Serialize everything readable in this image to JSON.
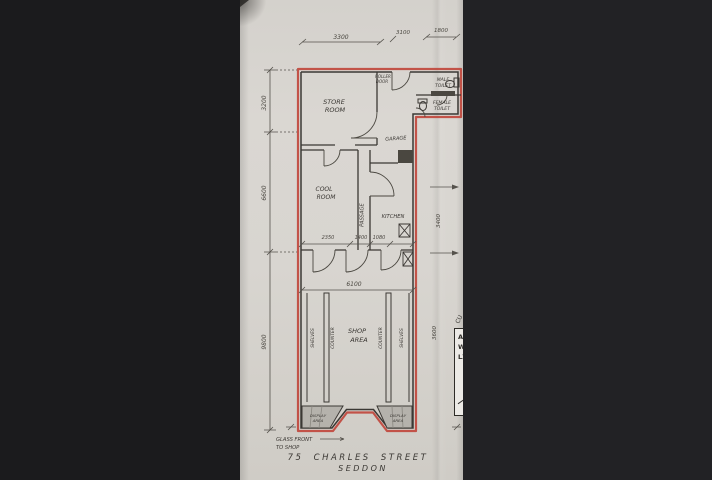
{
  "colors": {
    "bar_left": "#1b1b1d",
    "bar_right": "#222225",
    "paper": "#d8d5d0",
    "ink": "#3b3834",
    "boundary_red": "#bf4136"
  },
  "rooms": {
    "store_room": [
      "STORE",
      "ROOM"
    ],
    "roller_door": [
      "ROLLER",
      "DOOR"
    ],
    "male_toilet": [
      "MALE",
      "TOILET"
    ],
    "female_toilet": [
      "FEMALE",
      "TOILET"
    ],
    "garage": "GARAGE",
    "cool_room": [
      "COOL",
      "ROOM"
    ],
    "passage": "PASSAGE",
    "kitchen": "KITCHEN",
    "shop_area": [
      "SHOP",
      "AREA"
    ],
    "counter_left": "COUNTER",
    "counter_right": "COUNTER",
    "shelves_left": "SHELVES",
    "shelves_right": "SHELVES",
    "display_left": [
      "DISPLAY",
      "AREA"
    ],
    "display_right": [
      "DISPLAY",
      "AREA"
    ]
  },
  "dimensions": {
    "top": [
      "3300",
      "3100",
      "1800"
    ],
    "left": [
      "3200",
      "6600",
      "9800"
    ],
    "right": [
      "3400",
      "3600"
    ],
    "middle_row": [
      "2350",
      "1400",
      "1080"
    ],
    "shop_width": "6100"
  },
  "annotations": {
    "glass_front": [
      "GLASS FRONT",
      "TO SHOP"
    ]
  },
  "title": {
    "line1": "75 CHARLES STREET",
    "line2": "SEDDON"
  },
  "stamp": {
    "rotated": "CU",
    "lines": [
      "AR",
      "W.",
      "LX"
    ]
  }
}
